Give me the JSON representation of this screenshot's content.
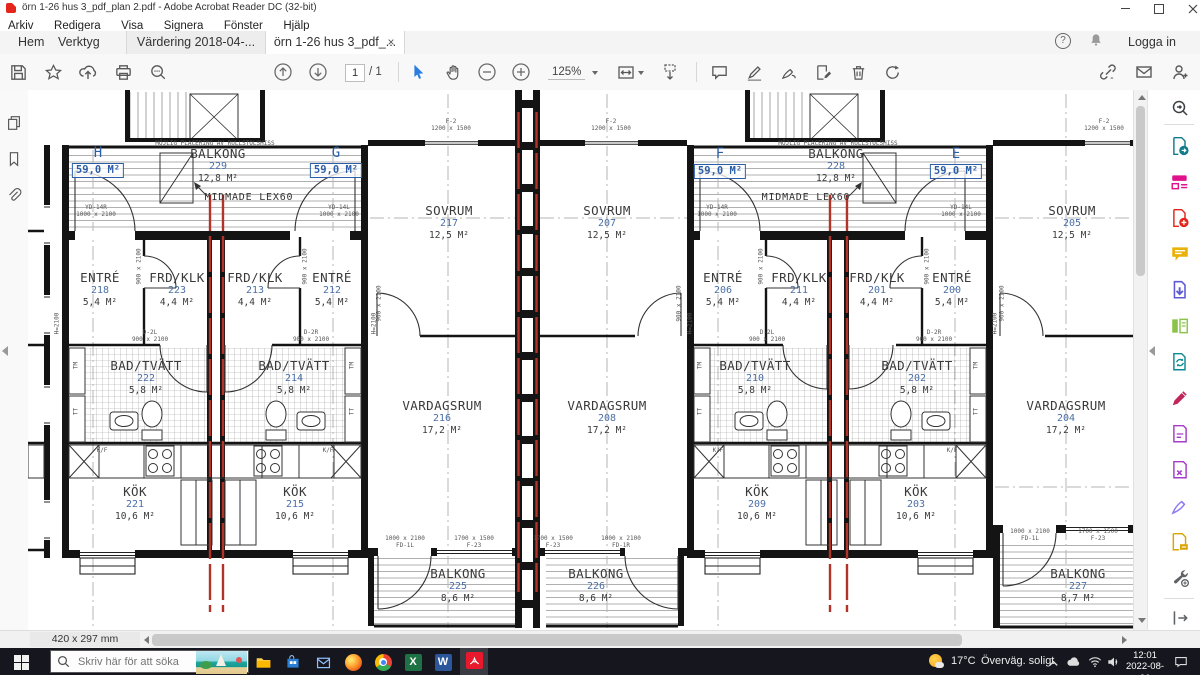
{
  "window": {
    "title": "örn 1-26 hus 3_pdf_plan 2.pdf - Adobe Acrobat Reader DC (32-bit)"
  },
  "menu": {
    "items": [
      "Arkiv",
      "Redigera",
      "Visa",
      "Signera",
      "Fönster",
      "Hjälp"
    ]
  },
  "tabbar": {
    "hem": "Hem",
    "verktyg": "Verktyg",
    "tab_inactive": "Värdering 2018-04-...",
    "tab_active": "örn 1-26 hus 3_pdf_...",
    "close": "×",
    "help": "?",
    "login": "Logga in"
  },
  "toolbar": {
    "page_current": "1",
    "page_total": "/ 1",
    "zoom_level": "125%"
  },
  "statusbar": {
    "page_size": "420 x 297 mm"
  },
  "taskbar": {
    "search_placeholder": "Skriv här för att söka",
    "temp": "17°C",
    "weather": "Överväg. soligt",
    "time": "12:01",
    "date": "2022-08-26",
    "excel_letter": "X",
    "word_letter": "W"
  },
  "plan": {
    "apartments": [
      {
        "letter": "H",
        "area": "59,0 M²"
      },
      {
        "letter": "G",
        "area": "59,0 M²"
      },
      {
        "letter": "F",
        "area": "59,0 M²"
      },
      {
        "letter": "E",
        "area": "59,0 M²"
      }
    ],
    "rooms": [
      {
        "name": "BALKONG",
        "number": "229",
        "area": "12,8 M²"
      },
      {
        "name": "BALKONG",
        "number": "228",
        "area": "12,8 M²"
      },
      {
        "name": "SOVRUM",
        "number": "217",
        "area": "12,5 M²"
      },
      {
        "name": "SOVRUM",
        "number": "207",
        "area": "12,5 M²"
      },
      {
        "name": "SOVRUM",
        "number": "205",
        "area": "12,5 M²"
      },
      {
        "name": "ENTRÉ",
        "number": "218",
        "area": "5,4 M²"
      },
      {
        "name": "FRD/KLK",
        "number": "223",
        "area": "4,4 M²"
      },
      {
        "name": "FRD/KLK",
        "number": "213",
        "area": "4,4 M²"
      },
      {
        "name": "ENTRÉ",
        "number": "212",
        "area": "5,4 M²"
      },
      {
        "name": "ENTRÉ",
        "number": "206",
        "area": "5,4 M²"
      },
      {
        "name": "FRD/KLK",
        "number": "211",
        "area": "4,4 M²"
      },
      {
        "name": "FRD/KLK",
        "number": "201",
        "area": "4,4 M²"
      },
      {
        "name": "ENTRÉ",
        "number": "200",
        "area": "5,4 M²"
      },
      {
        "name": "BAD/TVÄTT",
        "number": "222",
        "area": "5,8 M²"
      },
      {
        "name": "BAD/TVÄTT",
        "number": "214",
        "area": "5,8 M²"
      },
      {
        "name": "BAD/TVÄTT",
        "number": "210",
        "area": "5,8 M²"
      },
      {
        "name": "BAD/TVÄTT",
        "number": "202",
        "area": "5,8 M²"
      },
      {
        "name": "VARDAGSRUM",
        "number": "216",
        "area": "17,2 M²"
      },
      {
        "name": "VARDAGSRUM",
        "number": "208",
        "area": "17,2 M²"
      },
      {
        "name": "VARDAGSRUM",
        "number": "204",
        "area": "17,2 M²"
      },
      {
        "name": "KÖK",
        "number": "221",
        "area": "10,6 M²"
      },
      {
        "name": "KÖK",
        "number": "215",
        "area": "10,6 M²"
      },
      {
        "name": "KÖK",
        "number": "209",
        "area": "10,6 M²"
      },
      {
        "name": "KÖK",
        "number": "203",
        "area": "10,6 M²"
      },
      {
        "name": "BALKONG",
        "number": "225",
        "area": "8,6 M²"
      },
      {
        "name": "BALKONG",
        "number": "226",
        "area": "8,6 M²"
      },
      {
        "name": "BALKONG",
        "number": "227",
        "area": "8,7 M²"
      }
    ],
    "labels": {
      "midmade": "MIDMADE LEX60",
      "mojlig": "MÖJLIG PLACERING AV RULLSTOLSHISS",
      "yd_r": "YD-14R",
      "yd_l": "YD-14L",
      "yd_size": "1000 x 2100",
      "h2100": "H=2100",
      "tm": "TM",
      "tt": "TT",
      "kf": "K/F",
      "d2l": "D-2L",
      "d2r": "D-2R",
      "d_size": "900 x 2100",
      "fd_l": "FD-1L",
      "fd_r": "FD-1R",
      "fd_size": "1000 x 2100",
      "f23": "F-23",
      "f23_size": "1700 x 1500",
      "f2": "F-2",
      "f2_size": "1200 x 1500"
    },
    "colors": {
      "annotation_red": "#b23327",
      "label_blue": "#4a6fa8",
      "badge_blue": "#2b5ea7"
    }
  }
}
